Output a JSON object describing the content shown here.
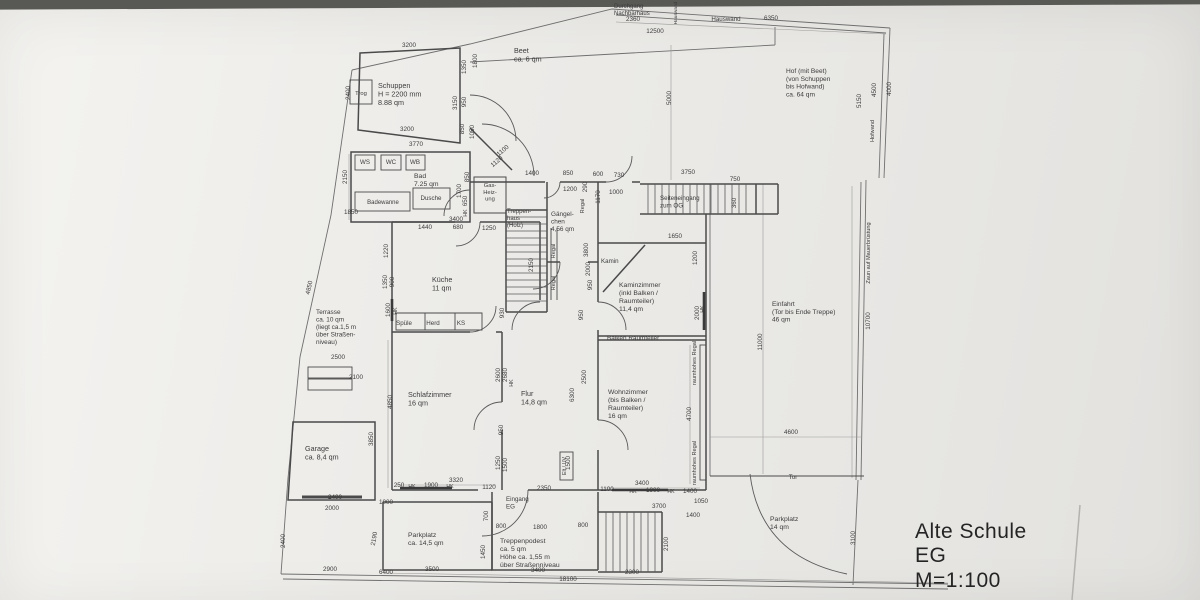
{
  "palette": {
    "paper": "#edecea",
    "ink": "#3c3c3c",
    "dim_ink": "#6c6c6c",
    "wall_ink": "#4a4a4a"
  },
  "title_block": {
    "line1": "Alte Schule",
    "line2": "EG",
    "line3": "M=1:100"
  },
  "drawing": {
    "rooms": [
      {
        "n": "room-label-schuppen",
        "t": "Schuppen\nH = 2200 mm\n8.88 qm",
        "x": 378,
        "y": 88
      },
      {
        "n": "room-label-beet",
        "t": "Beet\nca. 6 qm",
        "x": 514,
        "y": 53
      },
      {
        "n": "room-label-hof",
        "t": "Hof (mit Beet)\n(von Schuppen\nbis Hofwand)\nca. 64 qm",
        "x": 786,
        "y": 73,
        "s": 6.6
      },
      {
        "n": "room-label-bad",
        "t": "Bad\n7.25 qm",
        "x": 414,
        "y": 178,
        "s": 6.8
      },
      {
        "n": "room-label-kueche",
        "t": "Küche\n11 qm",
        "x": 432,
        "y": 282
      },
      {
        "n": "room-label-gaengelchen",
        "t": "Gängel-\nchen\n4,56 qm",
        "x": 551,
        "y": 216,
        "s": 6.4
      },
      {
        "n": "room-label-treppenhaus",
        "t": "Treppen-\nhaus\n(Holz)",
        "x": 507,
        "y": 213,
        "s": 6.0
      },
      {
        "n": "room-label-kaminzimmer",
        "t": "Kaminzimmer\n(inkl Balken /\nRaumteiler)\n11,4 qm",
        "x": 619,
        "y": 287,
        "s": 6.8
      },
      {
        "n": "room-label-terrasse",
        "t": "Terrasse\nca. 10 qm\n(liegt ca.1,5 m\nüber Straßen-\nniveau)",
        "x": 316,
        "y": 314,
        "s": 6.4
      },
      {
        "n": "room-label-schlafzimmer",
        "t": "Schlafzimmer\n16 qm",
        "x": 408,
        "y": 397
      },
      {
        "n": "room-label-flur",
        "t": "Flur\n14,8 qm",
        "x": 521,
        "y": 396
      },
      {
        "n": "room-label-wohnzimmer",
        "t": "Wohnzimmer\n(bis Balken /\nRaumteiler)\n16 qm",
        "x": 608,
        "y": 394,
        "s": 6.8
      },
      {
        "n": "room-label-einfahrt",
        "t": "Einfahrt\n(Tor bis Ende Treppe)\n46 qm",
        "x": 772,
        "y": 306,
        "s": 6.6
      },
      {
        "n": "room-label-garage",
        "t": "Garage\nca. 8,4 qm",
        "x": 305,
        "y": 451
      },
      {
        "n": "room-label-parkplatz-sued",
        "t": "Parkplatz\nca. 14,5 qm",
        "x": 408,
        "y": 537,
        "s": 6.8
      },
      {
        "n": "room-label-treppenpodest",
        "t": "Treppenpodest\nca. 5 qm\nHöhe ca. 1,55 m\nüber Straßenniveau",
        "x": 500,
        "y": 543,
        "s": 6.8
      },
      {
        "n": "room-label-parkplatz-ost",
        "t": "Parkplatz\n14 qm",
        "x": 770,
        "y": 521,
        "s": 6.8
      },
      {
        "n": "room-label-eingang-eg",
        "t": "Eingang\nEG",
        "x": 506,
        "y": 501,
        "s": 6.2
      },
      {
        "n": "room-label-seiteneingang",
        "t": "Seiteneingang\nzum OG",
        "x": 660,
        "y": 200,
        "s": 6.2
      },
      {
        "n": "room-label-kamin",
        "t": "Kamin",
        "x": 601,
        "y": 263,
        "s": 6.2
      },
      {
        "n": "annotation-balken-raumteiler",
        "t": "Balken Raumteiler",
        "x": 607,
        "y": 340,
        "s": 6.4
      },
      {
        "n": "annotation-durchgang-nachbarhaus",
        "t": "Durchgang\nNachbarhaus",
        "x": 614,
        "y": 8,
        "s": 6.0
      }
    ],
    "fixtures": [
      {
        "n": "fixture-ws",
        "t": "WS",
        "x": 365,
        "y": 164
      },
      {
        "n": "fixture-wc",
        "t": "WC",
        "x": 391,
        "y": 164
      },
      {
        "n": "fixture-wb",
        "t": "WB",
        "x": 415,
        "y": 164
      },
      {
        "n": "fixture-badewanne",
        "t": "Badewanne",
        "x": 383,
        "y": 204,
        "s": 6.0
      },
      {
        "n": "fixture-dusche",
        "t": "Dusche",
        "x": 431,
        "y": 200
      },
      {
        "n": "fixture-gas-heizung",
        "t": "Gas-\nHeiz-\nung",
        "x": 490,
        "y": 187,
        "s": 5.8
      },
      {
        "n": "fixture-spuele",
        "t": "Spüle",
        "x": 404,
        "y": 325
      },
      {
        "n": "fixture-herd",
        "t": "Herd",
        "x": 433,
        "y": 325
      },
      {
        "n": "fixture-ks",
        "t": "KS",
        "x": 461,
        "y": 325
      },
      {
        "n": "fixture-trog",
        "t": "Trog",
        "x": 361,
        "y": 95,
        "s": 5.8
      },
      {
        "n": "fixture-elt-uv",
        "t": "Elt / UV",
        "x": 566,
        "y": 466,
        "r": -90,
        "s": 5.4
      }
    ],
    "annotations": [
      {
        "n": "annotation-hauswand-top",
        "t": "Hauswand",
        "x": 726,
        "y": 21
      },
      {
        "n": "annotation-hauswand-klein",
        "t": "Hauswand",
        "x": 677,
        "y": 13,
        "r": -90,
        "s": 4.8
      },
      {
        "n": "annotation-hofwand",
        "t": "Hofwand",
        "x": 874,
        "y": 131,
        "r": -90,
        "s": 5.6
      },
      {
        "n": "annotation-zaun",
        "t": "Zaun auf Mauerbrüstung",
        "x": 870,
        "y": 253,
        "r": -90,
        "s": 5.6
      },
      {
        "n": "annotation-tor",
        "t": "Tor",
        "x": 793,
        "y": 479,
        "s": 6.2
      },
      {
        "n": "annotation-regal-1",
        "t": "Regal",
        "x": 584,
        "y": 206,
        "r": -90,
        "s": 5.6
      },
      {
        "n": "annotation-regal-2",
        "t": "Regal",
        "x": 555,
        "y": 251,
        "r": -90,
        "s": 5.6
      },
      {
        "n": "annotation-regal-3",
        "t": "Regal",
        "x": 555,
        "y": 283,
        "r": -90,
        "s": 5.6
      },
      {
        "n": "annotation-raumhohes-regal-1",
        "t": "raumhohes Regal",
        "x": 696,
        "y": 363,
        "r": -90,
        "s": 5.6
      },
      {
        "n": "annotation-raumhohes-regal-2",
        "t": "raumhohes Regal",
        "x": 696,
        "y": 463,
        "r": -90,
        "s": 5.6
      },
      {
        "n": "annotation-hk-1",
        "t": "HK",
        "x": 412,
        "y": 488,
        "s": 5.2
      },
      {
        "n": "annotation-hk-2",
        "t": "HK",
        "x": 450,
        "y": 488,
        "s": 5.2
      },
      {
        "n": "annotation-hk-3",
        "t": "HK",
        "x": 633,
        "y": 493,
        "s": 5.2
      },
      {
        "n": "annotation-hk-4",
        "t": "HK",
        "x": 671,
        "y": 493,
        "s": 5.2
      },
      {
        "n": "annotation-hk-5",
        "t": "HK",
        "x": 397,
        "y": 311,
        "r": -90,
        "s": 5.2
      },
      {
        "n": "annotation-hk-6",
        "t": "HK",
        "x": 467,
        "y": 213,
        "r": -90,
        "s": 5.2
      },
      {
        "n": "annotation-hk-7",
        "t": "HK",
        "x": 704,
        "y": 309,
        "r": -90,
        "s": 5.2
      },
      {
        "n": "annotation-hk-8",
        "t": "HK",
        "x": 513,
        "y": 383,
        "r": -90,
        "s": 5.2
      }
    ],
    "dimensions": [
      {
        "t": "3200",
        "x": 409,
        "y": 47
      },
      {
        "t": "3200",
        "x": 407,
        "y": 131
      },
      {
        "t": "2400",
        "x": 350,
        "y": 93,
        "r": -90
      },
      {
        "t": "1350",
        "x": 466,
        "y": 67,
        "r": -90
      },
      {
        "t": "1800",
        "x": 477,
        "y": 61,
        "r": -90
      },
      {
        "t": "3150",
        "x": 457,
        "y": 103,
        "r": -90
      },
      {
        "t": "950",
        "x": 466,
        "y": 102,
        "r": -90
      },
      {
        "t": "850",
        "x": 464,
        "y": 129,
        "r": -90
      },
      {
        "t": "1050",
        "x": 474,
        "y": 132,
        "r": -90
      },
      {
        "t": "3770",
        "x": 416,
        "y": 146
      },
      {
        "t": "1100",
        "x": 504,
        "y": 152,
        "r": -40
      },
      {
        "t": "1120",
        "x": 498,
        "y": 163,
        "r": -40
      },
      {
        "t": "2360",
        "x": 633,
        "y": 21
      },
      {
        "t": "12500",
        "x": 655,
        "y": 33
      },
      {
        "t": "6350",
        "x": 771,
        "y": 20
      },
      {
        "t": "5000",
        "x": 671,
        "y": 98,
        "r": -90
      },
      {
        "t": "5150",
        "x": 861,
        "y": 101,
        "r": -90
      },
      {
        "t": "4500",
        "x": 876,
        "y": 90,
        "r": -90
      },
      {
        "t": "4000",
        "x": 891,
        "y": 89,
        "r": -90
      },
      {
        "t": "2150",
        "x": 347,
        "y": 177,
        "r": -90
      },
      {
        "t": "1850",
        "x": 351,
        "y": 214
      },
      {
        "t": "850",
        "x": 469,
        "y": 177,
        "r": -90
      },
      {
        "t": "1700",
        "x": 461,
        "y": 191,
        "r": -90
      },
      {
        "t": "650",
        "x": 467,
        "y": 201,
        "r": -90
      },
      {
        "t": "3400",
        "x": 456,
        "y": 221
      },
      {
        "t": "1440",
        "x": 425,
        "y": 229
      },
      {
        "t": "680",
        "x": 458,
        "y": 229
      },
      {
        "t": "1250",
        "x": 489,
        "y": 230
      },
      {
        "t": "1400",
        "x": 532,
        "y": 175
      },
      {
        "t": "850",
        "x": 568,
        "y": 175
      },
      {
        "t": "600",
        "x": 598,
        "y": 176
      },
      {
        "t": "730",
        "x": 619,
        "y": 177
      },
      {
        "t": "1200",
        "x": 570,
        "y": 191
      },
      {
        "t": "290",
        "x": 587,
        "y": 187,
        "r": -90
      },
      {
        "t": "1170",
        "x": 600,
        "y": 197,
        "r": -90
      },
      {
        "t": "1000",
        "x": 616,
        "y": 194
      },
      {
        "t": "3750",
        "x": 688,
        "y": 174
      },
      {
        "t": "750",
        "x": 735,
        "y": 181
      },
      {
        "t": "360",
        "x": 736,
        "y": 203,
        "r": -90
      },
      {
        "t": "1650",
        "x": 675,
        "y": 238
      },
      {
        "t": "1220",
        "x": 388,
        "y": 251,
        "r": -90
      },
      {
        "t": "1350",
        "x": 387,
        "y": 282,
        "r": -90
      },
      {
        "t": "900",
        "x": 394,
        "y": 282,
        "r": -90
      },
      {
        "t": "1600",
        "x": 390,
        "y": 310,
        "r": -90
      },
      {
        "t": "2150",
        "x": 533,
        "y": 265,
        "r": -90
      },
      {
        "t": "930",
        "x": 504,
        "y": 313,
        "r": -90
      },
      {
        "t": "3800",
        "x": 588,
        "y": 250,
        "r": -90
      },
      {
        "t": "2000",
        "x": 590,
        "y": 269,
        "r": -90
      },
      {
        "t": "950",
        "x": 592,
        "y": 285,
        "r": -90
      },
      {
        "t": "950",
        "x": 583,
        "y": 315,
        "r": -90
      },
      {
        "t": "2500",
        "x": 586,
        "y": 377,
        "r": -90
      },
      {
        "t": "6300",
        "x": 574,
        "y": 395,
        "r": -90
      },
      {
        "t": "1200",
        "x": 697,
        "y": 258,
        "r": -90
      },
      {
        "t": "2000",
        "x": 699,
        "y": 313,
        "r": -90
      },
      {
        "t": "4700",
        "x": 691,
        "y": 414,
        "r": -90
      },
      {
        "t": "11000",
        "x": 762,
        "y": 342,
        "r": -90
      },
      {
        "t": "10700",
        "x": 870,
        "y": 321,
        "r": -90
      },
      {
        "t": "4600",
        "x": 791,
        "y": 434
      },
      {
        "t": "3100",
        "x": 855,
        "y": 538,
        "r": -90
      },
      {
        "t": "4850",
        "x": 392,
        "y": 402,
        "r": -90
      },
      {
        "t": "4850",
        "x": 311,
        "y": 288,
        "r": -78
      },
      {
        "t": "2600",
        "x": 500,
        "y": 375,
        "r": -90
      },
      {
        "t": "2680",
        "x": 507,
        "y": 375,
        "r": -90
      },
      {
        "t": "950",
        "x": 503,
        "y": 430,
        "r": -90
      },
      {
        "t": "1250",
        "x": 500,
        "y": 463,
        "r": -90
      },
      {
        "t": "1500",
        "x": 507,
        "y": 465,
        "r": -90
      },
      {
        "t": "1500",
        "x": 570,
        "y": 463,
        "r": -90
      },
      {
        "t": "3320",
        "x": 456,
        "y": 482
      },
      {
        "t": "250",
        "x": 399,
        "y": 487
      },
      {
        "t": "1900",
        "x": 431,
        "y": 487
      },
      {
        "t": "1120",
        "x": 489,
        "y": 489
      },
      {
        "t": "2350",
        "x": 544,
        "y": 490
      },
      {
        "t": "3400",
        "x": 642,
        "y": 485
      },
      {
        "t": "1100",
        "x": 607,
        "y": 491
      },
      {
        "t": "1900",
        "x": 653,
        "y": 492
      },
      {
        "t": "1400",
        "x": 690,
        "y": 493
      },
      {
        "t": "1050",
        "x": 701,
        "y": 503
      },
      {
        "t": "3700",
        "x": 659,
        "y": 508
      },
      {
        "t": "1400",
        "x": 693,
        "y": 517
      },
      {
        "t": "2100",
        "x": 668,
        "y": 544,
        "r": -90
      },
      {
        "t": "2300",
        "x": 632,
        "y": 574
      },
      {
        "t": "1000",
        "x": 386,
        "y": 504
      },
      {
        "t": "700",
        "x": 488,
        "y": 516,
        "r": -90
      },
      {
        "t": "1450",
        "x": 485,
        "y": 552,
        "r": -90
      },
      {
        "t": "800",
        "x": 501,
        "y": 528
      },
      {
        "t": "1800",
        "x": 540,
        "y": 529
      },
      {
        "t": "800",
        "x": 583,
        "y": 527
      },
      {
        "t": "3500",
        "x": 432,
        "y": 571
      },
      {
        "t": "3400",
        "x": 538,
        "y": 572
      },
      {
        "t": "6400",
        "x": 386,
        "y": 574
      },
      {
        "t": "18100",
        "x": 568,
        "y": 581
      },
      {
        "t": "2900",
        "x": 330,
        "y": 571
      },
      {
        "t": "2400",
        "x": 335,
        "y": 499
      },
      {
        "t": "2000",
        "x": 332,
        "y": 510
      },
      {
        "t": "2400",
        "x": 285,
        "y": 541,
        "r": -90
      },
      {
        "t": "2190",
        "x": 376,
        "y": 539,
        "r": -80
      },
      {
        "t": "3850",
        "x": 373,
        "y": 439,
        "r": -90
      },
      {
        "t": "2500",
        "x": 338,
        "y": 359
      },
      {
        "t": "2100",
        "x": 356,
        "y": 379
      }
    ]
  }
}
